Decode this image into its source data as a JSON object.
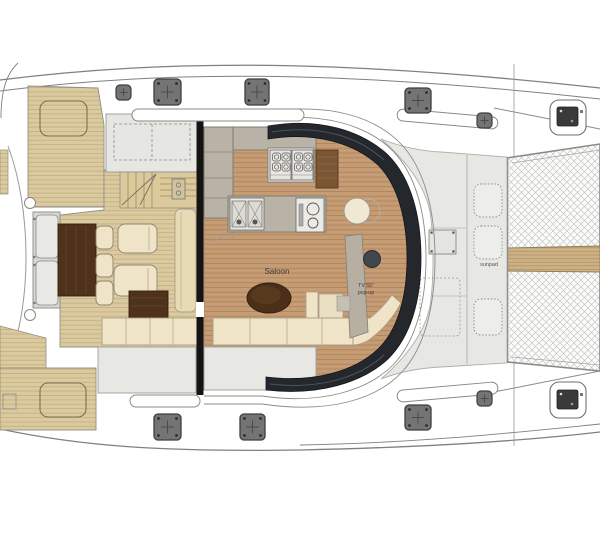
{
  "labels": {
    "saloon": "Saloon",
    "tv_55": "TV 55\"",
    "tv_popup": "pop-up",
    "sunpad": "sunpad"
  },
  "palette": {
    "teak": "#dbcaa0",
    "teak_line": "#bfab7c",
    "saloon_wood": "#c69c75",
    "saloon_wood_line": "#a87e57",
    "glass_dark": "#24272c",
    "counter_gray": "#b9b3a7",
    "sofa_cream": "#efe4c8",
    "dark_wood": "#4e321b",
    "deck_gray": "#e7e7e4",
    "overhang_gray": "#e6e6e3",
    "hull_line": "#808080",
    "hatch_gray": "#747474",
    "bench_gray": "#d7d7d3",
    "cabinet_brown": "#7a5634",
    "label_ink": "#3a3a3a"
  }
}
